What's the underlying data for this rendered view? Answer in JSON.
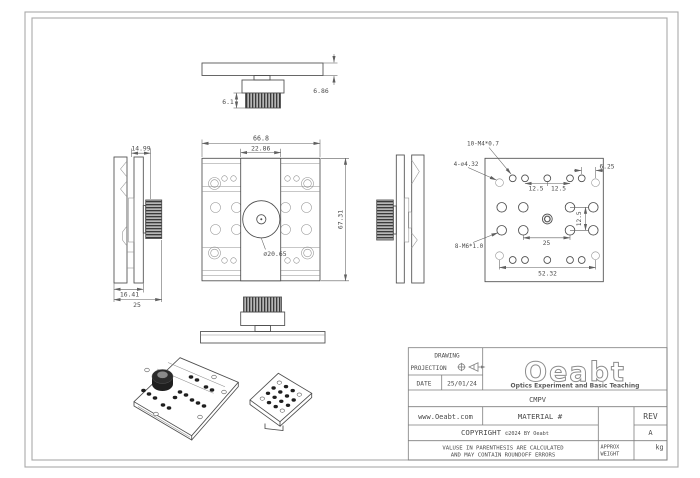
{
  "views": {
    "top": {
      "dim_knob_height": "6.1",
      "dim_plate_thickness": "6.86"
    },
    "front": {
      "dim_width": "66.8",
      "dim_slider_width": "22.86",
      "dim_height": "67.31",
      "dim_bore": "⌀20.65"
    },
    "left_side": {
      "dim_top": "14.99",
      "dim_bottom": "16.41",
      "dim_total": "25"
    },
    "back": {
      "label_m4": "10-M4*0.7",
      "label_cbore": "4-⌀4.32",
      "dim_edge": "6.25",
      "dim_pitch_a": "12.5",
      "dim_pitch_b": "12.5",
      "dim_pitch_v": "12.5",
      "dim_center": "25",
      "label_m6": "8-M6*1.0",
      "dim_width": "52.32"
    }
  },
  "title_block": {
    "projection": {
      "line1": "DRAWING",
      "line2": "PROJECTION"
    },
    "date_label": "DATE",
    "date_value": "25/01/24",
    "logo": {
      "brand": "Oeabt",
      "tagline": "Optics Experiment and Basic Teaching"
    },
    "part_number": "CMPV",
    "website": "www.Oeabt.com",
    "material_label": "MATERIAL #",
    "rev_label": "REV",
    "rev_value": "A",
    "copyright": {
      "word": "COPYRIGHT",
      "notice": "©2024 BY Oeabt"
    },
    "disclaimer": {
      "line1": "VALUSE IN PARENTHESIS ARE CALCULATED",
      "line2": "AND MAY CONTAIN ROUNDOFF ERRORS"
    },
    "weight": {
      "label_line1": "APPROX",
      "label_line2": "WEIGHT",
      "unit": "kg"
    }
  },
  "colors": {
    "line": "#4d4d4d",
    "thin_line": "#8f8f8f",
    "frame": "#a9a9a9",
    "knurl_dark": "#3a3a3a",
    "background": "#ffffff"
  }
}
